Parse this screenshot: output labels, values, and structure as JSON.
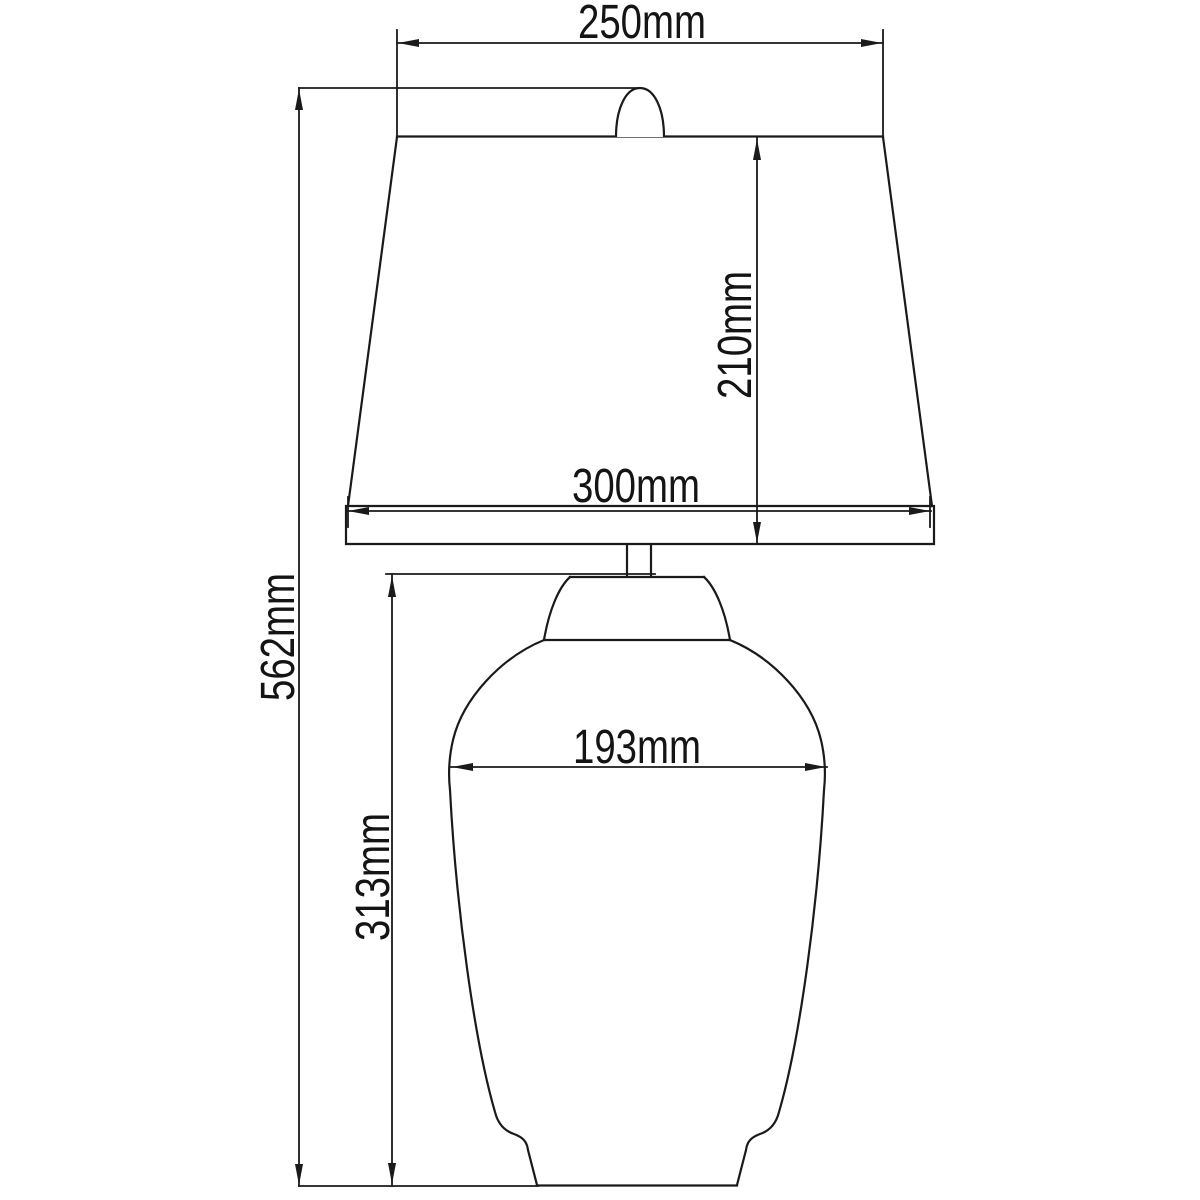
{
  "unit": "mm",
  "labels": {
    "shade_top_width": "250mm",
    "shade_height": "210mm",
    "shade_bottom_width": "300mm",
    "overall_height": "562mm",
    "body_width": "193mm",
    "body_height": "313mm"
  },
  "colors": {
    "line": "#1a1a1a",
    "text": "#141414",
    "background": "#ffffff"
  }
}
